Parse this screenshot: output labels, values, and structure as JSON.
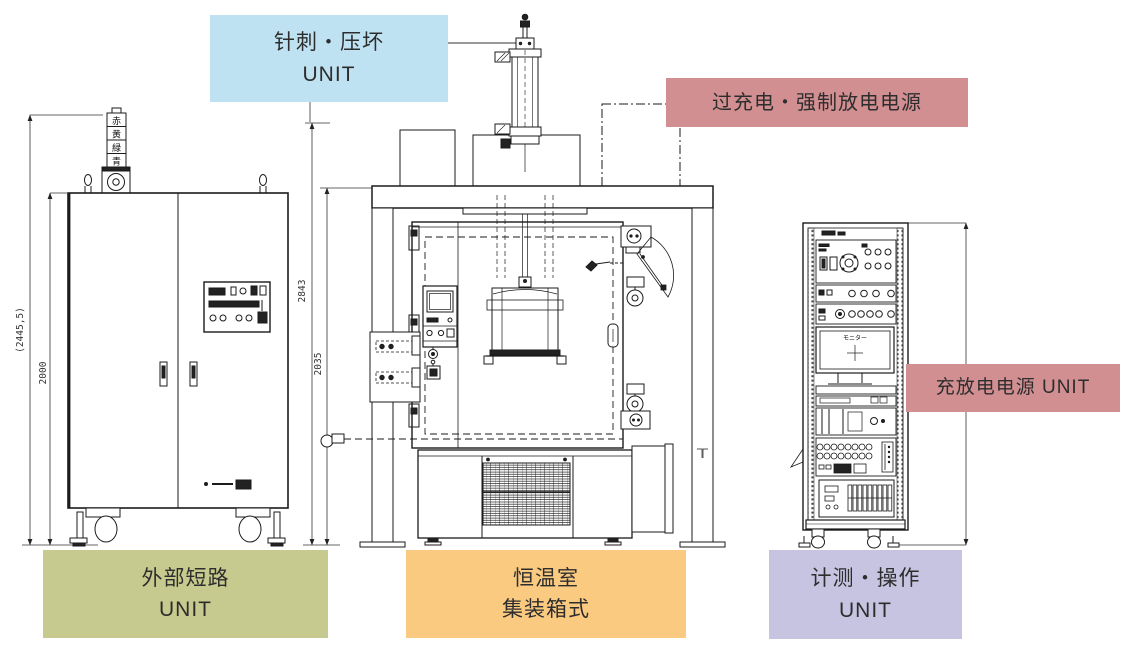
{
  "labels": {
    "nail_crush": {
      "line1": "针刺・压坏",
      "line2": "UNIT",
      "bg": "#bfe2f2"
    },
    "overcharge_psu": {
      "text": "过充电・强制放电电源",
      "bg": "#d28f92"
    },
    "charge_discharge": {
      "text": "充放电电源 UNIT",
      "bg": "#d28f92"
    },
    "external_short": {
      "line1": "外部短路",
      "line2": "UNIT",
      "bg": "#c7ca8e"
    },
    "thermo_room": {
      "line1": "恒温室",
      "line2": "集装箱式",
      "bg": "#fbca81"
    },
    "measurement": {
      "line1": "计测・操作",
      "line2": "UNIT",
      "bg": "#c7c4e1"
    }
  },
  "dimensions": {
    "left_total": "(2445,5)",
    "left_body": "2000",
    "center_total": "2843",
    "center_body": "2035"
  },
  "signal_tower": {
    "cells": [
      "赤",
      "黄",
      "緑",
      "青"
    ]
  },
  "rack": {
    "monitor_label": "モニター"
  }
}
